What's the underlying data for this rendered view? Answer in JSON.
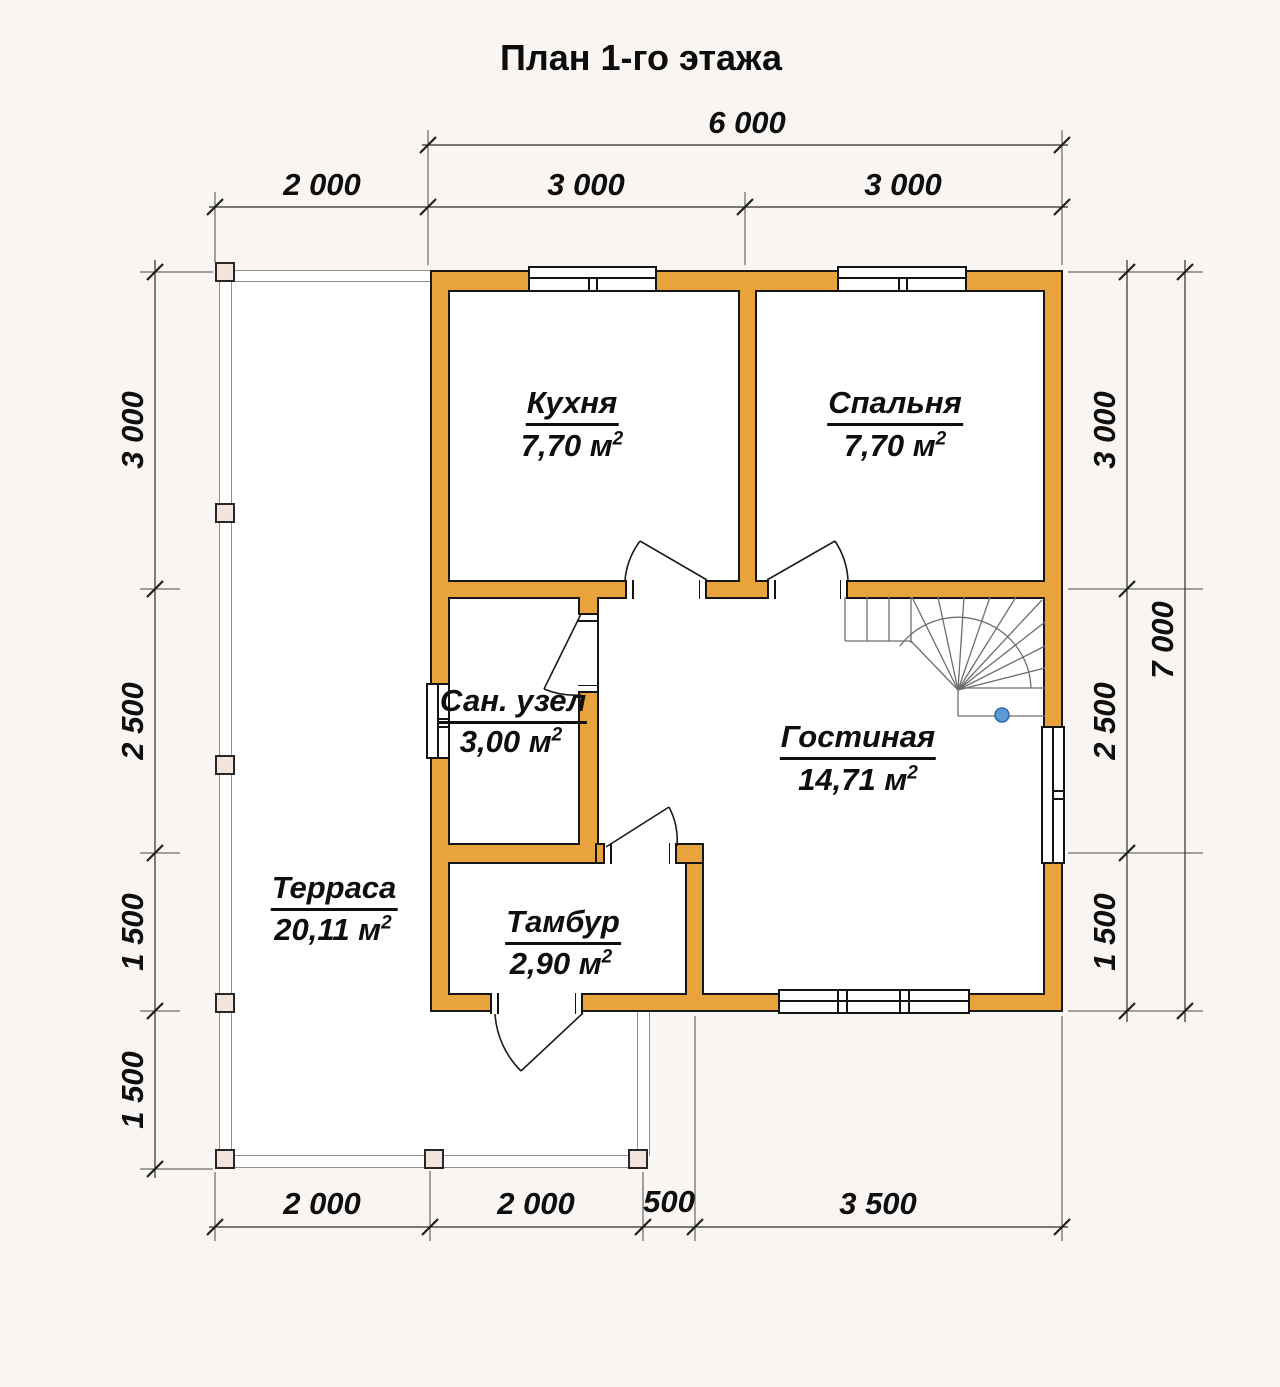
{
  "meta": {
    "sup": "2"
  },
  "title": "План 1-го этажа",
  "rooms": {
    "kitchen": {
      "name": "Кухня",
      "area": "7,70 м"
    },
    "bedroom": {
      "name": "Спальня",
      "area": "7,70 м"
    },
    "bathroom": {
      "name": "Сан. узел",
      "area": "3,00 м"
    },
    "living": {
      "name": "Гостиная",
      "area": "14,71 м"
    },
    "vestibule": {
      "name": "Тамбур",
      "area": "2,90 м"
    },
    "terrace": {
      "name": "Терраса",
      "area": "20,11 м"
    }
  },
  "dimensions": {
    "top_total": "6 000",
    "top": [
      "2 000",
      "3 000",
      "3 000"
    ],
    "bottom": [
      "2 000",
      "2 000",
      "500",
      "3 500"
    ],
    "left": [
      "3 000",
      "2 500",
      "1 500",
      "1 500"
    ],
    "right": [
      "3 000",
      "2 500",
      "1 500"
    ],
    "right_total": "7 000"
  },
  "colors": {
    "wall": "#e8a33c",
    "post_fill": "#f2e4dc",
    "stair_pole": "#5b9bd5",
    "terrace_line": "#8f8f8f"
  }
}
